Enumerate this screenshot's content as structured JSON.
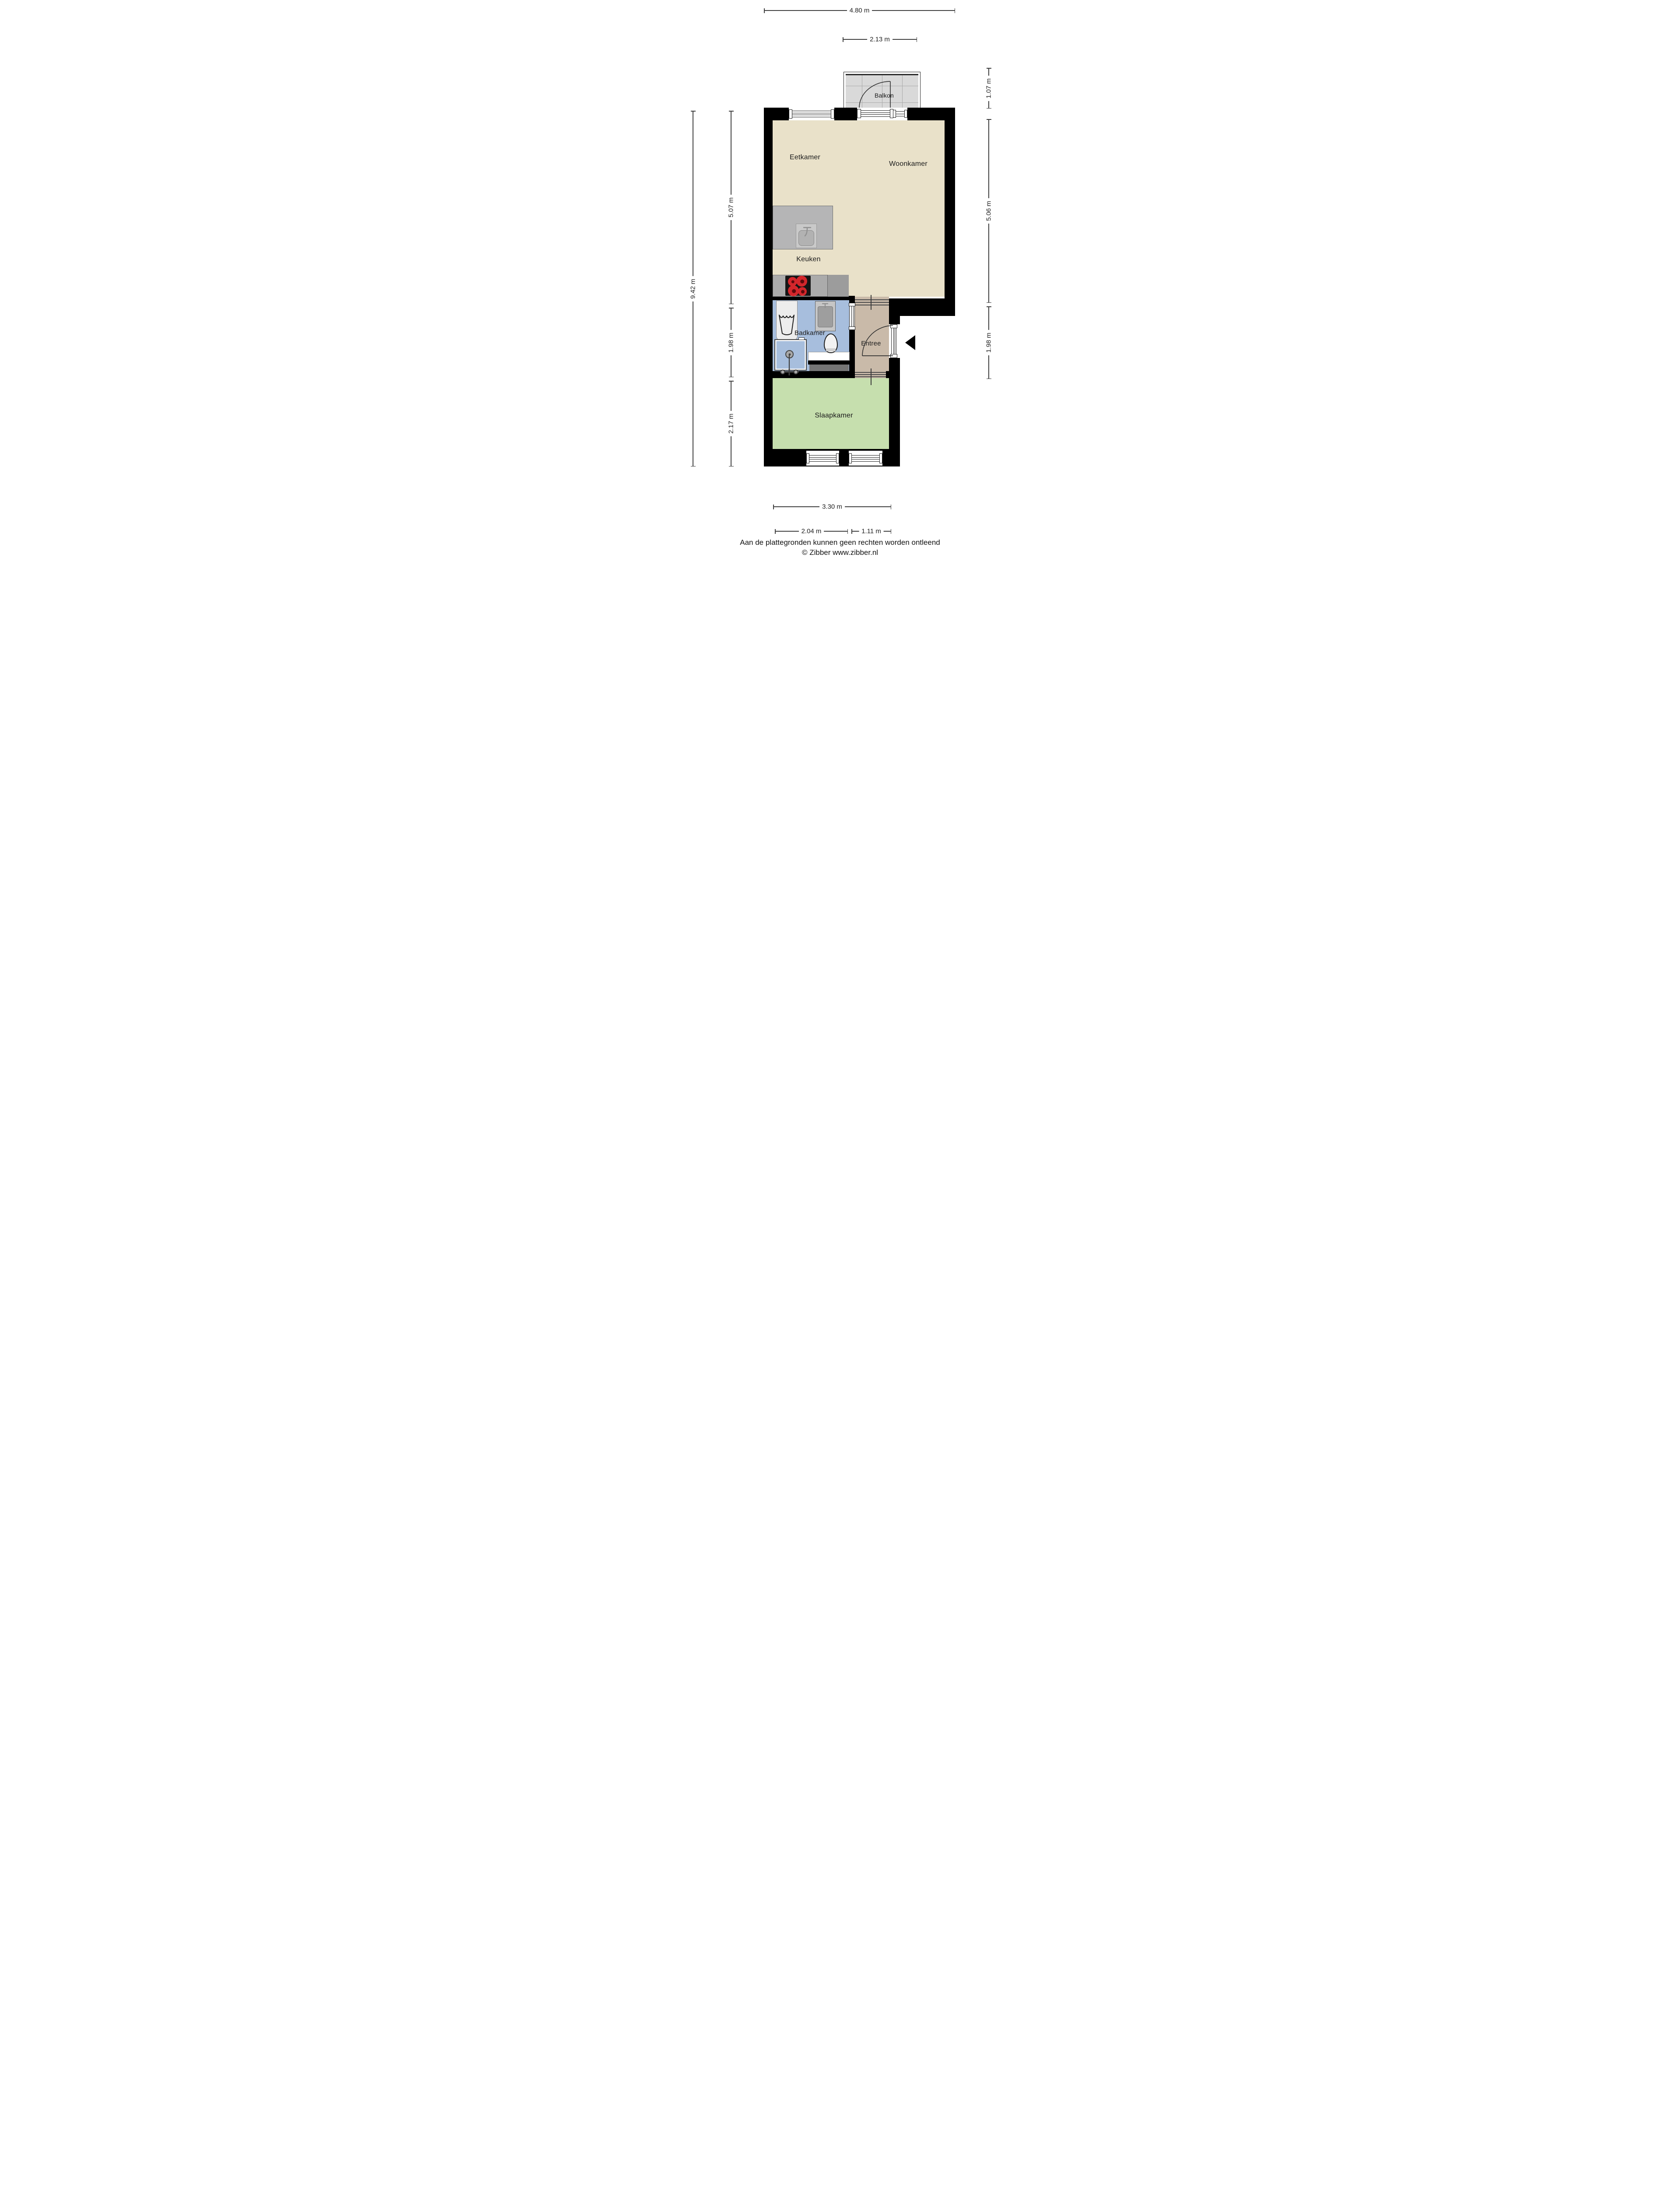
{
  "rooms": {
    "balkon": "Balkon",
    "eetkamer": "Eetkamer",
    "woonkamer": "Woonkamer",
    "keuken": "Keuken",
    "badkamer": "Badkamer",
    "entree": "Entree",
    "slaapkamer": "Slaapkamer"
  },
  "dimensions": {
    "top": [
      "4.80 m",
      "2.13 m"
    ],
    "left": [
      "9.42 m",
      "5.07 m",
      "1.98 m",
      "2.17 m"
    ],
    "right": [
      "1.07 m",
      "5.06 m",
      "1.98 m"
    ],
    "bottom": [
      "3.30 m",
      "2.04 m",
      "1.11 m"
    ]
  },
  "footer": {
    "line1": "Aan de plattegronden kunnen geen rechten worden ontleend",
    "line2": "© Zibber www.zibber.nl"
  },
  "icons": [
    "entrance-arrow",
    "washing-machine-icon",
    "shower-icon",
    "toilet-icon",
    "bathroom-sink-icon",
    "kitchen-island-sink-icon",
    "cooktop-icon",
    "balcony-door-arc",
    "front-door-arc"
  ],
  "colors": {
    "wall": "#000000",
    "living": "#e9e1c9",
    "bathroom": "#a7bedd",
    "hall": "#c9baa9",
    "bedroom": "#c6dfae",
    "balcony_tile": "#d9d9d9",
    "burner": "#d3262b",
    "mat": "#757575",
    "dimension": "#3f3f3f",
    "text": "#1a1a1a"
  }
}
